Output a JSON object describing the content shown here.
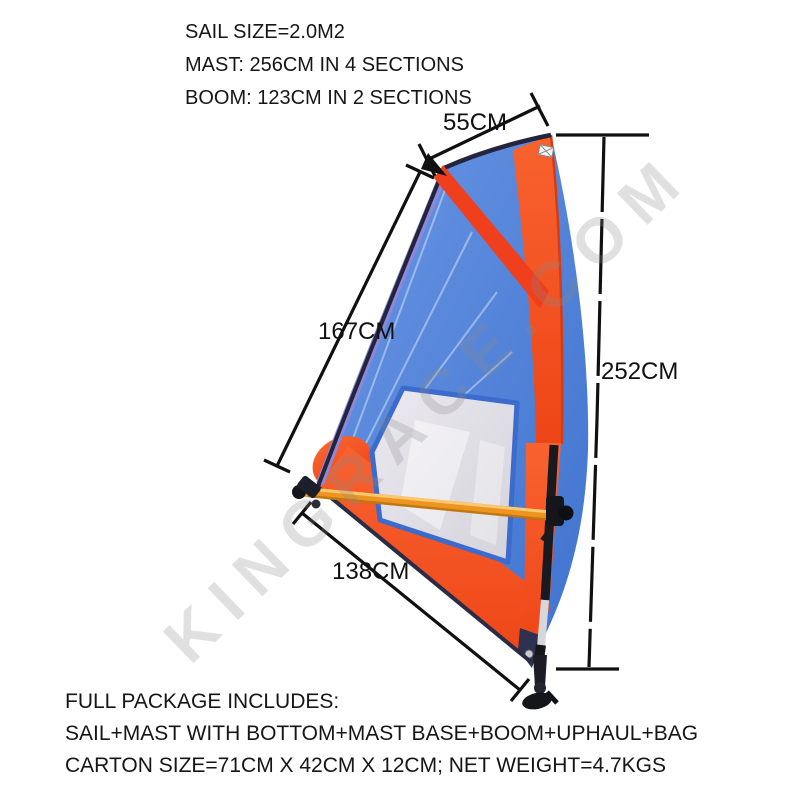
{
  "specs": {
    "sail_size": "SAIL SIZE=2.0M2",
    "mast": "MAST: 256CM IN 4 SECTIONS",
    "boom": "BOOM: 123CM IN 2 SECTIONS"
  },
  "dimensions": {
    "head_width": "55CM",
    "leech_length": "167CM",
    "overall_height": "252CM",
    "foot_length": "138CM"
  },
  "package": {
    "title": "FULL PACKAGE INCLUDES:",
    "contents": "SAIL+MAST WITH BOTTOM+MAST BASE+BOOM+UPHAUL+BAG",
    "carton": "CARTON SIZE=71CM X 42CM X 12CM; NET WEIGHT=4.7KGS"
  },
  "watermark": "KINGRACE.COM",
  "colors": {
    "sail_blue": "#4a7fd6",
    "sail_orange": "#f4501f",
    "luff_purple": "#8e88da",
    "trim_navy": "#23253c",
    "boom_orange": "#ed9520",
    "window_fill": "#dcdae2",
    "window_border": "#3b6bcc",
    "dimension_line": "#101010",
    "text": "#1a1a1a",
    "watermark_gray": "#8a8a8a"
  }
}
